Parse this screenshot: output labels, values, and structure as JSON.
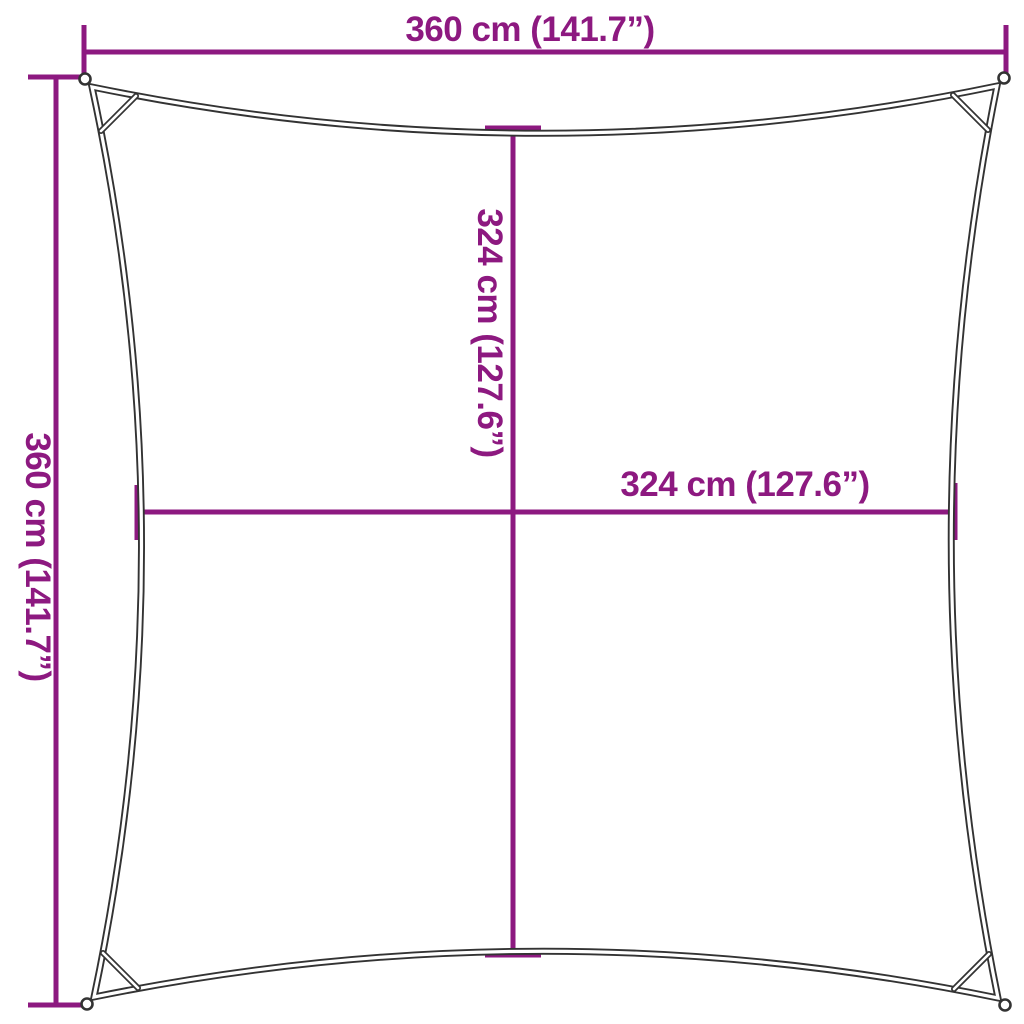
{
  "diagram": {
    "title": "shade-sail-dimension-diagram",
    "colors": {
      "accent": "#8d1980",
      "outline": "#333333",
      "background": "#ffffff"
    },
    "dimensions": {
      "top": {
        "label": "360 cm (141.7”)"
      },
      "left": {
        "label": "360 cm (141.7”)"
      },
      "middle_vertical": {
        "label": "324 cm (127.6”)"
      },
      "middle_horizontal": {
        "label": "324 cm (127.6”)"
      }
    }
  }
}
